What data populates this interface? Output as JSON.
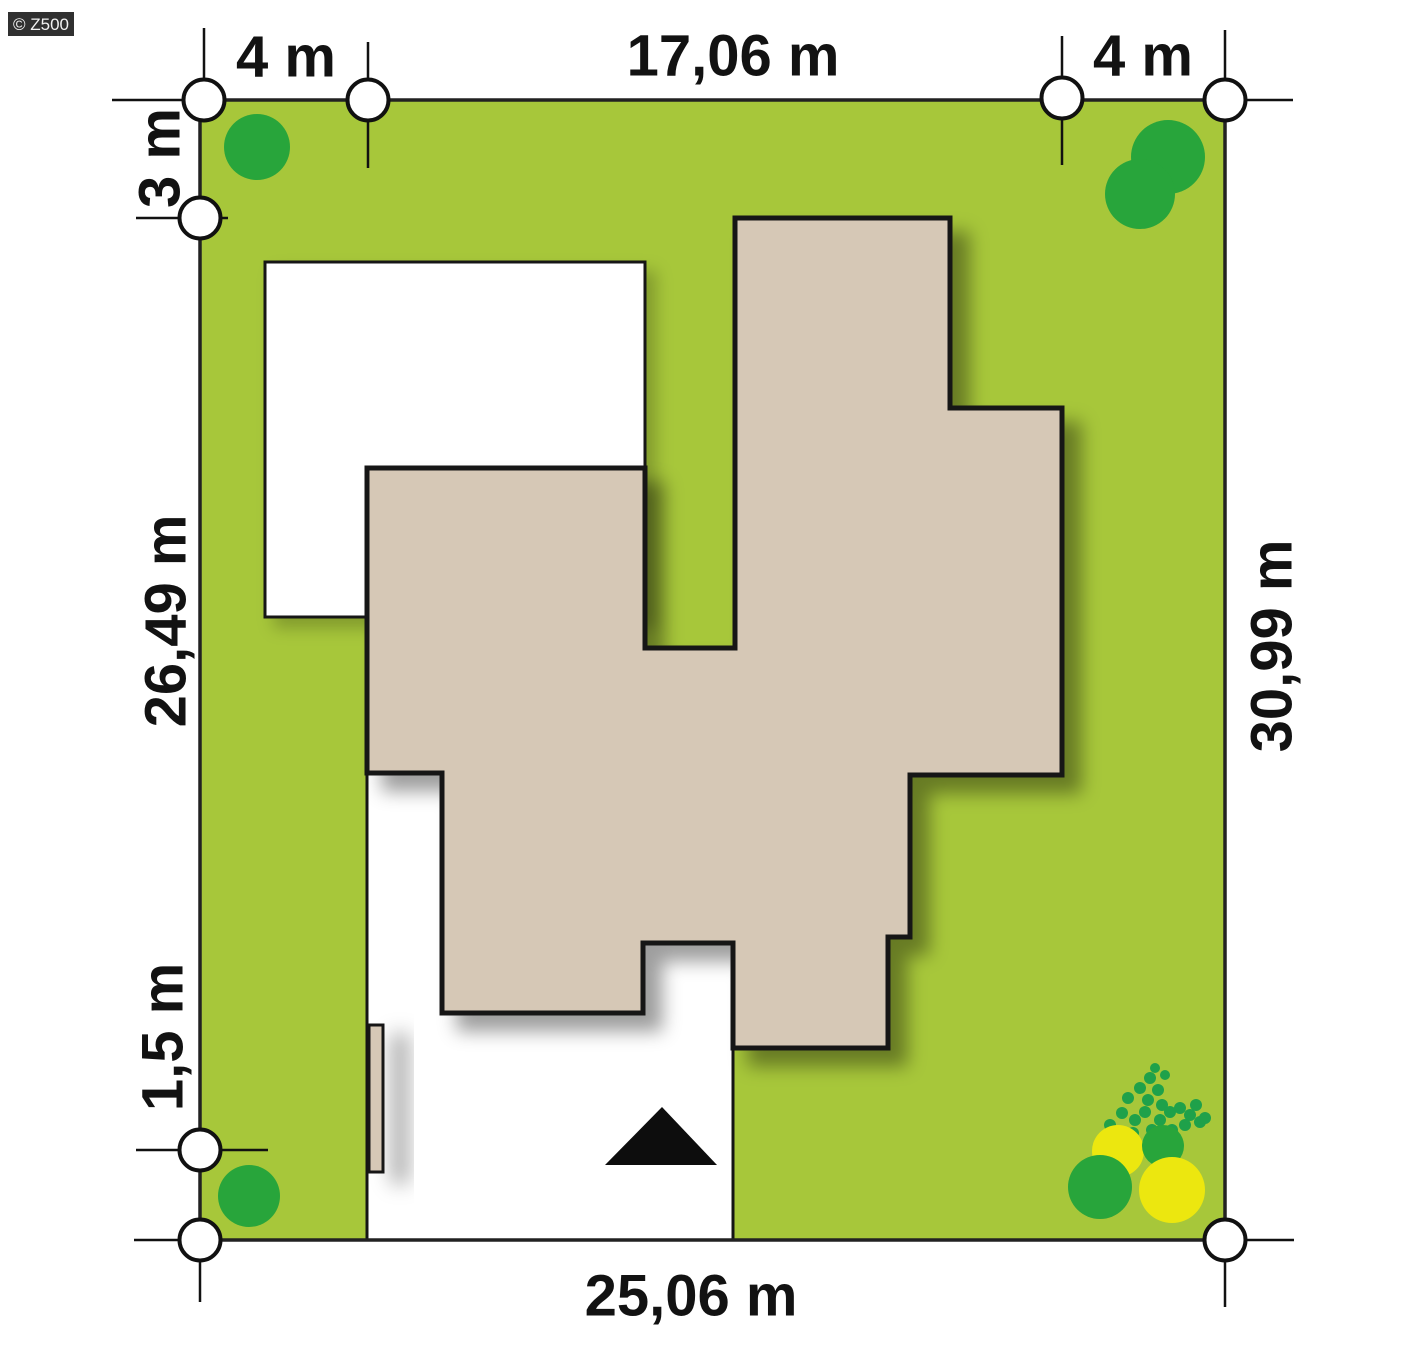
{
  "watermark": {
    "label": "© Z500"
  },
  "dimensions": {
    "top_left_setback": "4 m",
    "top_house_width": "17,06 m",
    "top_right_setback": "4 m",
    "left_top_setback": "3 m",
    "left_depth": "26,49 m",
    "left_bottom_setback": "1,5 m",
    "right_depth": "30,99 m",
    "bottom_width": "25,06 m"
  },
  "colors": {
    "grass": "#a7c73a",
    "house": "#d6c8b6",
    "terrace": "#ffffff",
    "driveway": "#ffffff",
    "gate": "#d6c8b6",
    "tree_green": "#28a53b",
    "shrub_green": "#1fa14a",
    "bush_yellow": "#ece70f",
    "outline": "#141414",
    "marker_fill": "#ffffff"
  }
}
